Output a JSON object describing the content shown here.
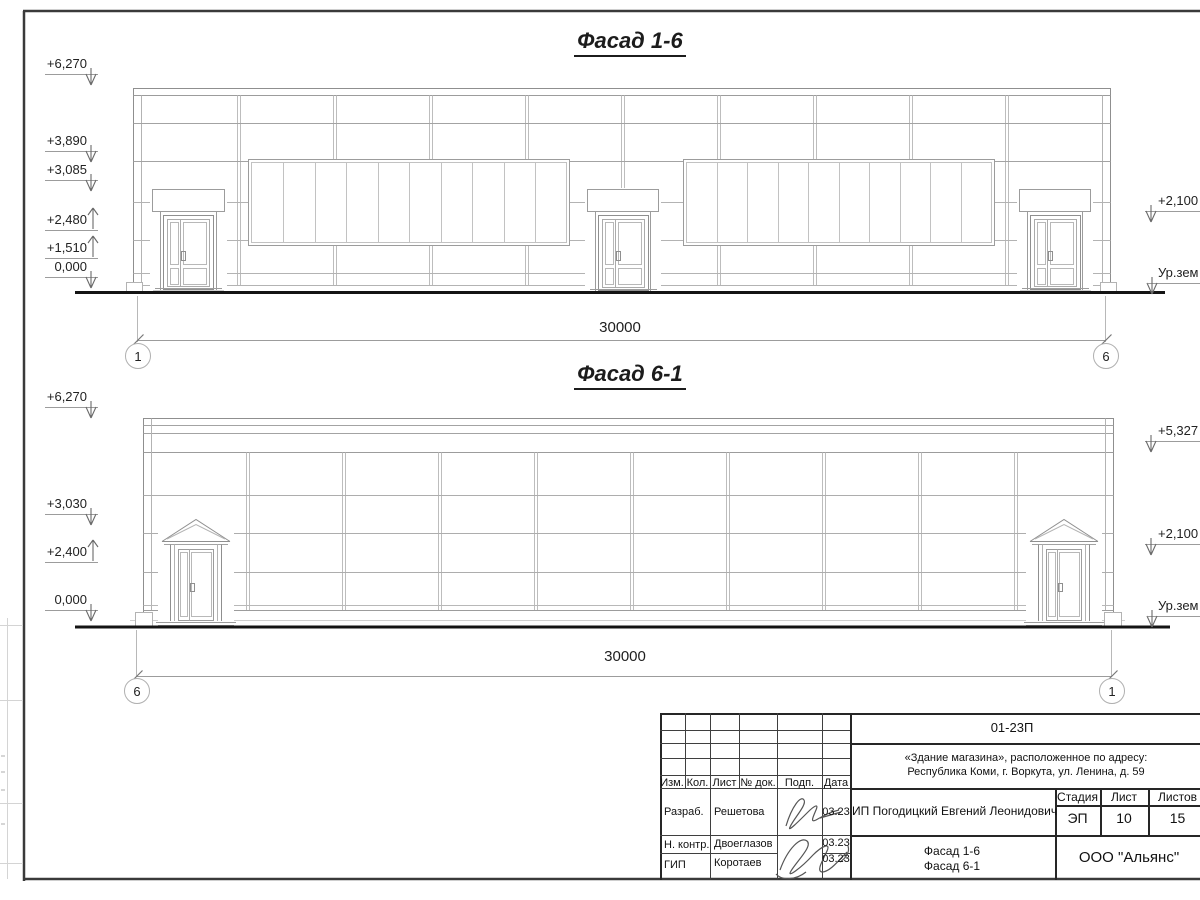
{
  "sheet": {
    "facade1": {
      "title": "Фасад 1-6",
      "marks_left": [
        "+6,270",
        "+3,890",
        "+3,085",
        "+2,480",
        "+1,510",
        "0,000"
      ],
      "marks_right": [
        "+2,100",
        "Ур.зем"
      ],
      "dimension": "30000",
      "axis_left": "1",
      "axis_right": "6"
    },
    "facade2": {
      "title": "Фасад 6-1",
      "marks_left": [
        "+6,270",
        "+3,030",
        "+2,400",
        "0,000"
      ],
      "marks_right": [
        "+5,327",
        "+2,100",
        "Ур.зем"
      ],
      "dimension": "30000",
      "axis_left": "6",
      "axis_right": "1"
    },
    "titleblock": {
      "code": "01-23П",
      "address_line1": "«Здание магазина», расположенное по адресу:",
      "address_line2": "Республика Коми, г. Воркута, ул. Ленина, д. 59",
      "columns": {
        "izm": "Изм.",
        "kol": "Кол.",
        "list": "Лист",
        "doc": "№ док.",
        "podp": "Подп.",
        "date": "Дата"
      },
      "rows": [
        {
          "role": "Разраб.",
          "name": "Решетова",
          "date": "03.23"
        },
        {
          "role": "Н. контр.",
          "name": "Двоеглазов",
          "date": "03.23"
        },
        {
          "role": "ГИП",
          "name": "Коротаев",
          "date": "03.23"
        }
      ],
      "client": "ИП Погодицкий Евгений Леонидович",
      "stage_label": "Стадия",
      "sheet_label": "Лист",
      "sheets_label": "Листов",
      "stage": "ЭП",
      "sheet_number": "10",
      "sheets_total": "15",
      "drawing_line1": "Фасад 1-6",
      "drawing_line2": "Фасад 6-1",
      "company": "ООО \"Альянс\"",
      "line_color": "#262626"
    }
  }
}
